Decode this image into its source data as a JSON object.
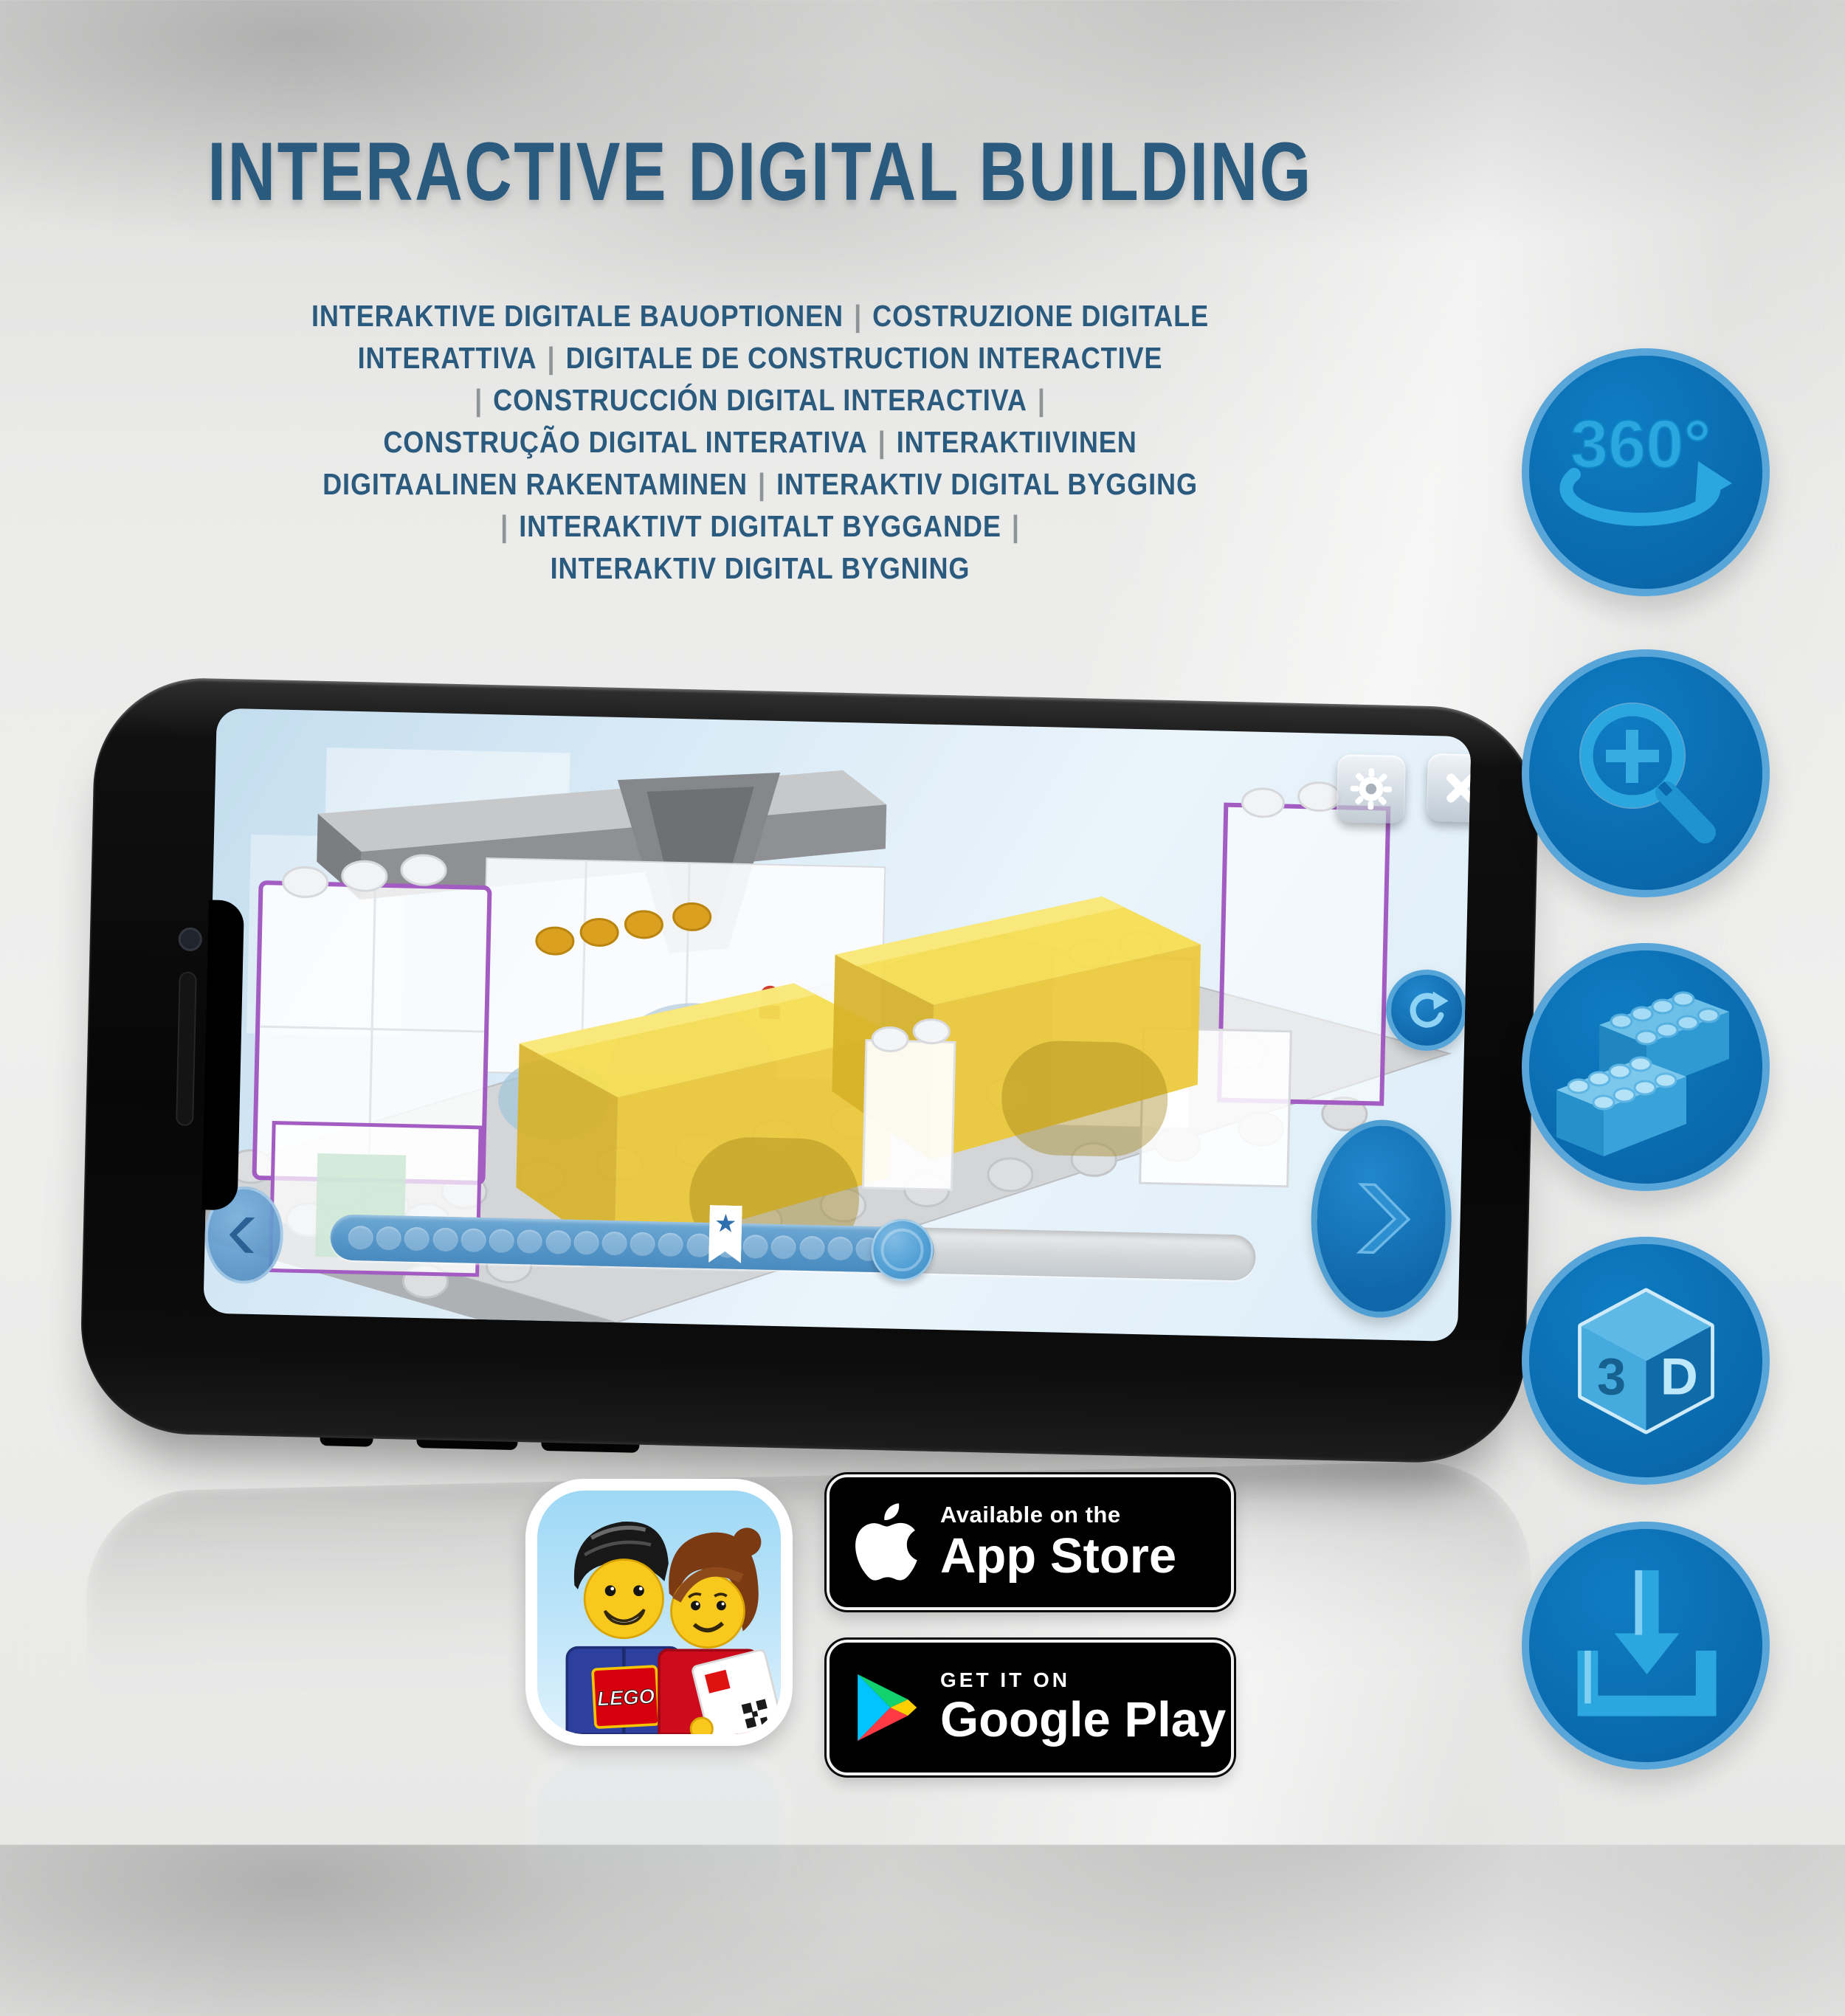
{
  "page": {
    "background_color": "#ecedec",
    "accent_blue": "#0b70b6",
    "icon_glyph_blue": "#2ba6de",
    "title_color": "#2a5a7d",
    "separator_color": "#8f9496"
  },
  "header": {
    "title": "INTERACTIVE DIGITAL BUILDING"
  },
  "subtitle_lines": [
    [
      "INTERAKTIVE DIGITALE BAUOPTIONEN",
      "|",
      "COSTRUZIONE DIGITALE"
    ],
    [
      "INTERATTIVA",
      "|",
      "DIGITALE DE CONSTRUCTION INTERACTIVE"
    ],
    [
      "|",
      "CONSTRUCCIÓN DIGITAL INTERACTIVA",
      "|"
    ],
    [
      "CONSTRUÇÃO DIGITAL INTERATIVA",
      "|",
      "INTERAKTIIVINEN"
    ],
    [
      "DIGITAALINEN RAKENTAMINEN",
      "|",
      "INTERAKTIV DIGITAL BYGGING"
    ],
    [
      "|",
      "INTERAKTIVT DIGITALT BYGGANDE",
      "|"
    ],
    [
      "INTERAKTIV DIGITAL BYGNING"
    ]
  ],
  "feature_icons": {
    "rotation_label": "360°",
    "cube_left": "3",
    "cube_right": "D"
  },
  "phone_app": {
    "slider_dot_count": 19,
    "brick_stud_logo": "LEGO"
  },
  "store_badges": {
    "lego_app_logo": "LEGO",
    "app_store": {
      "tagline": "Available on the",
      "store_name": "App Store"
    },
    "google_play": {
      "tagline": "GET IT ON",
      "store_name": "Google Play"
    }
  }
}
